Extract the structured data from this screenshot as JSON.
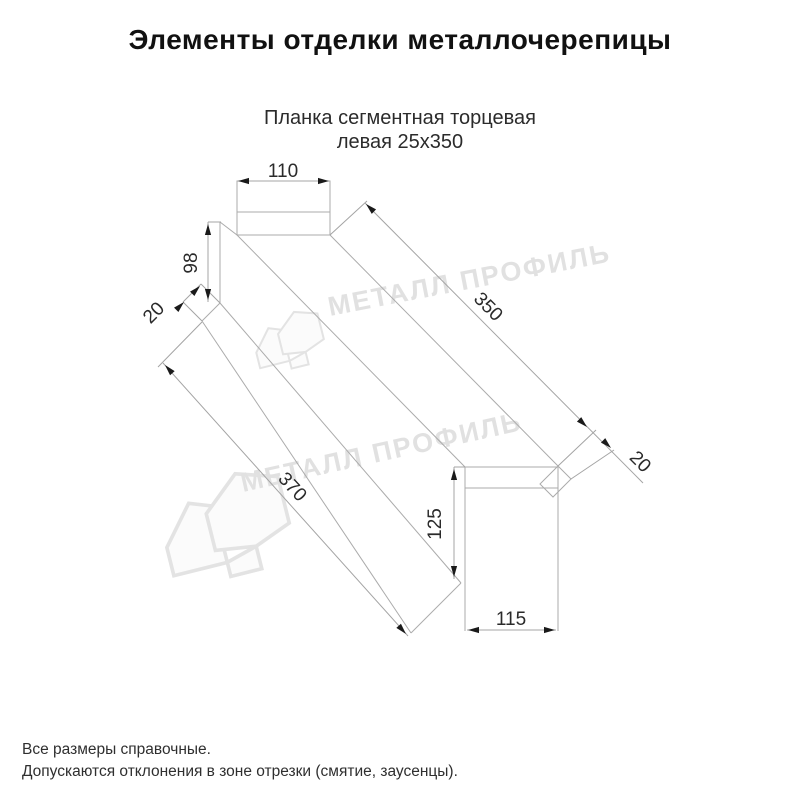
{
  "title": "Элементы отделки металлочерепицы",
  "subtitle": {
    "line1": "Планка сегментная торцевая",
    "line2": "левая 25х350"
  },
  "dimensions": {
    "top_flange_width": "110",
    "near_end_height": "98",
    "near_end_fold": "20",
    "top_edge_length": "350",
    "far_end_fold": "20",
    "bottom_edge_length": "370",
    "far_end_height": "125",
    "far_end_width": "115"
  },
  "watermark": {
    "text": "МЕТАЛЛ ПРОФИЛЬ"
  },
  "footer": {
    "line1": "Все размеры справочные.",
    "line2": "Допускаются отклонения в зоне отрезки (смятие, заусенцы)."
  },
  "colors": {
    "line": "#ababab",
    "dimension_text": "#2a2a2a",
    "arrow": "#1a1a1a",
    "watermark": "#e1e1e1",
    "title_text": "#111111"
  }
}
